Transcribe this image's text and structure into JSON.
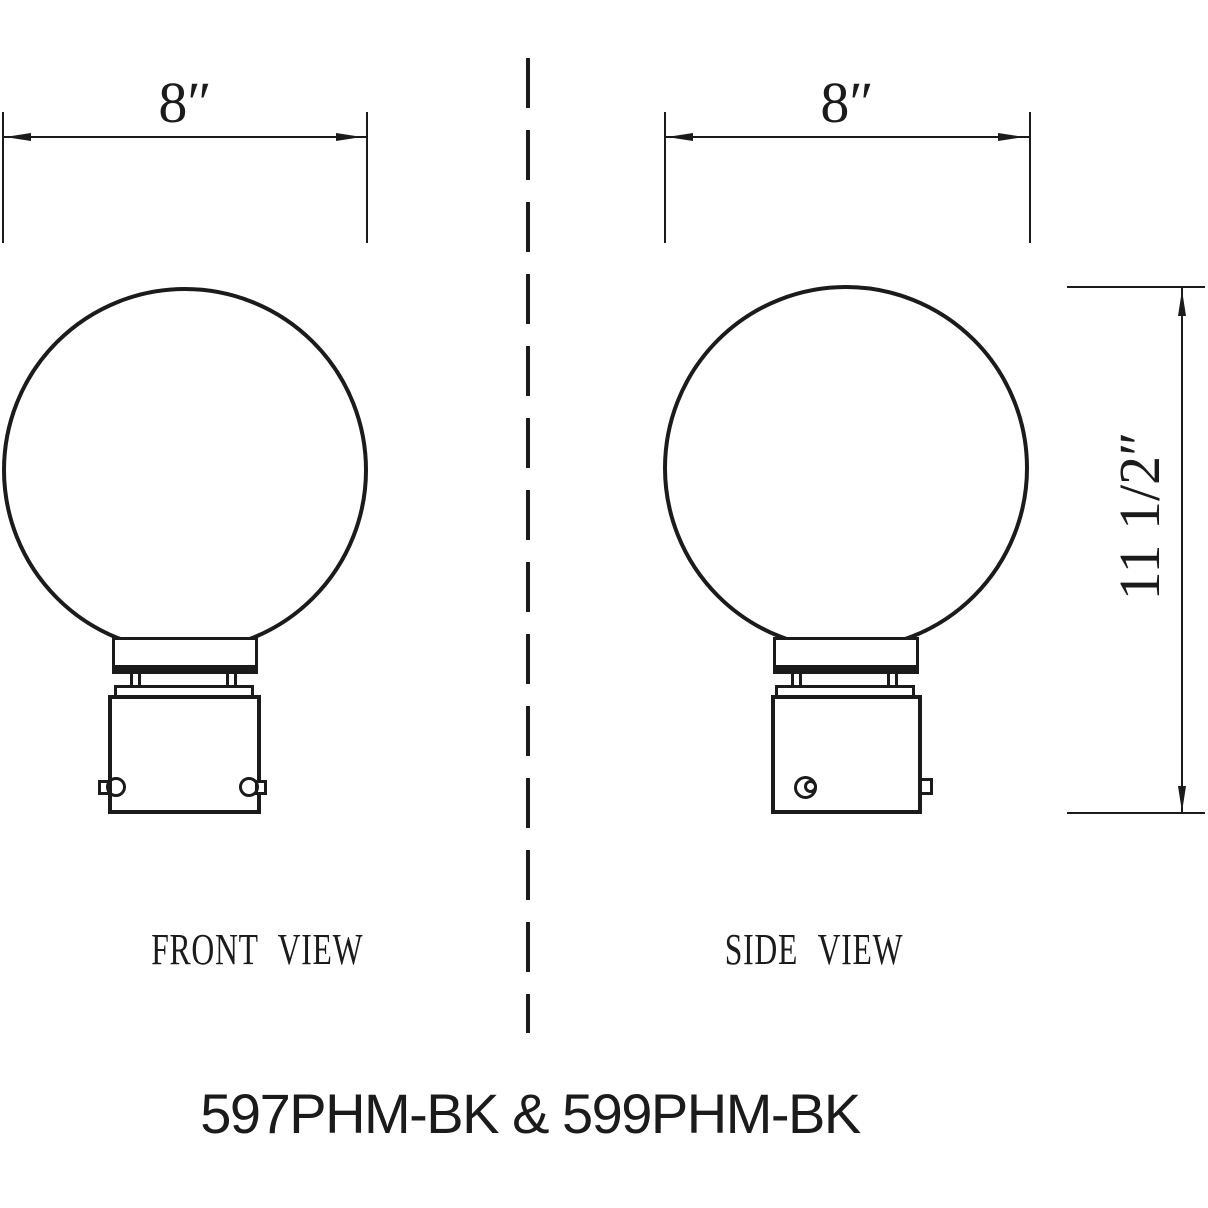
{
  "drawing": {
    "title": "597PHM-BK & 599PHM-BK",
    "views": {
      "front": {
        "label": "FRONT VIEW",
        "width_dim": "8″"
      },
      "side": {
        "label": "SIDE VIEW",
        "width_dim": "8″",
        "height_dim": "11 1/2″"
      }
    },
    "colors": {
      "line": "#1b1b1b",
      "background": "#ffffff"
    }
  }
}
